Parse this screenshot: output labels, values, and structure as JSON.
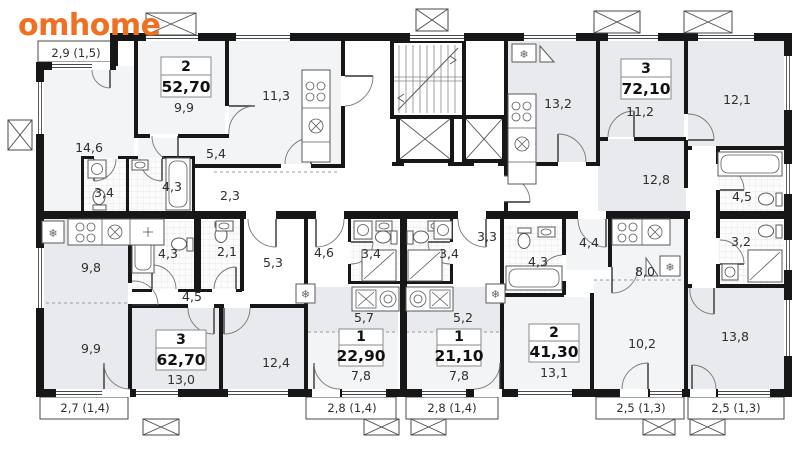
{
  "brand": {
    "logo_text": "omhome",
    "logo_color": "#ee7123"
  },
  "apartments": [
    {
      "rooms": "2",
      "area": "52,70"
    },
    {
      "rooms": "3",
      "area": "72,10"
    },
    {
      "rooms": "3",
      "area": "62,70"
    },
    {
      "rooms": "1",
      "area": "22,90"
    },
    {
      "rooms": "1",
      "area": "21,10"
    },
    {
      "rooms": "2",
      "area": "41,30"
    }
  ],
  "room_labels": {
    "r146": "14,6",
    "r99a": "9,9",
    "r113": "11,3",
    "r54": "5,4",
    "r34a": "3,4",
    "r43a": "4,3",
    "r23": "2,3",
    "r132": "13,2",
    "r112": "11,2",
    "r121": "12,1",
    "r128": "12,8",
    "r45r": "4,5",
    "r32": "3,2",
    "r138": "13,8",
    "r98": "9,8",
    "r43b": "4,3",
    "r21": "2,1",
    "r53": "5,3",
    "r45h": "4,5",
    "r99b": "9,9",
    "r130": "13,0",
    "r124": "12,4",
    "r46": "4,6",
    "r34b": "3,4",
    "r34c": "3,4",
    "r33": "3,3",
    "r57": "5,7",
    "r52": "5,2",
    "r78a": "7,8",
    "r78b": "7,8",
    "r43c": "4,3",
    "r44": "4,4",
    "r80": "8,0",
    "r131": "13,1",
    "r102": "10,2"
  },
  "balconies": {
    "b1": "2,9 (1,5)",
    "b2": "2,7 (1,4)",
    "b3": "2,8 (1,4)",
    "b4": "2,8 (1,4)",
    "b5": "2,5 (1,3)",
    "b6": "2,5 (1,3)"
  },
  "icons": {
    "ac_unit": "❄"
  }
}
